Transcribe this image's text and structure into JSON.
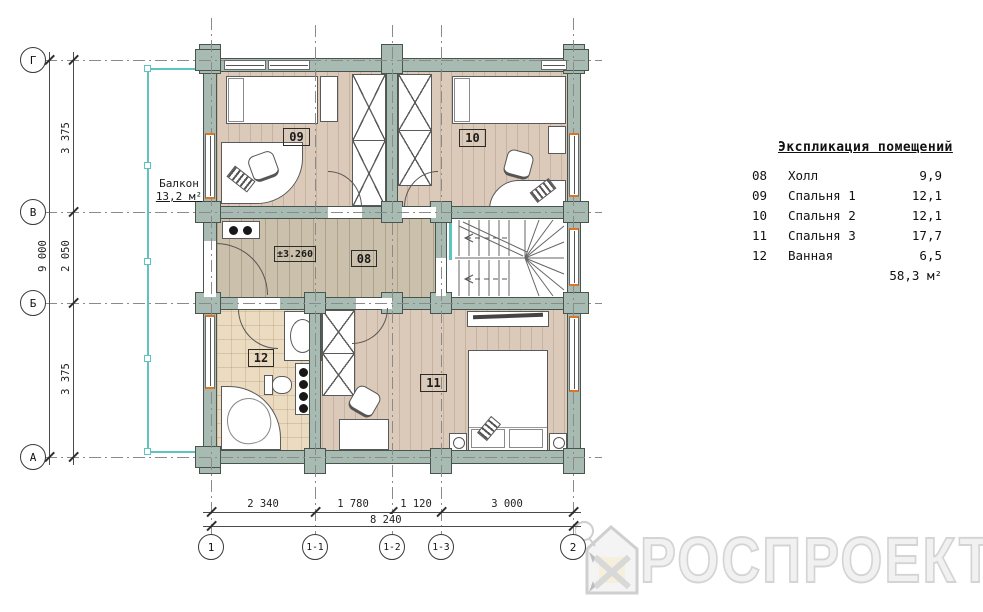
{
  "drawing": {
    "axes_rows": [
      {
        "label": "Г"
      },
      {
        "label": "В"
      },
      {
        "label": "Б"
      },
      {
        "label": "А"
      }
    ],
    "axes_cols": [
      {
        "label": "1"
      },
      {
        "label": "1-1"
      },
      {
        "label": "1-2"
      },
      {
        "label": "1-3"
      },
      {
        "label": "2"
      }
    ],
    "dims_left": {
      "seg1": "3 375",
      "seg2": "2 050",
      "seg3": "3 375",
      "overall": "9 000"
    },
    "dims_bottom": {
      "seg1": "2 340",
      "seg2": "1 780",
      "seg3": "1 120",
      "seg4": "3 000",
      "overall": "8 240"
    },
    "balcony": {
      "name": "Балкон",
      "area": "13,2 м²"
    },
    "elevation": "±3.260",
    "rooms": {
      "hall": "08",
      "bed1": "09",
      "bed2": "10",
      "bed3": "11",
      "bath": "12"
    }
  },
  "legend": {
    "title": "Экспликация помещений",
    "rows": [
      {
        "num": "08",
        "name": "Холл",
        "area": "9,9"
      },
      {
        "num": "09",
        "name": "Спальня 1",
        "area": "12,1"
      },
      {
        "num": "10",
        "name": "Спальня 2",
        "area": "12,1"
      },
      {
        "num": "11",
        "name": "Спальня 3",
        "area": "17,7"
      },
      {
        "num": "12",
        "name": "Ванная",
        "area": "6,5"
      }
    ],
    "total": "58,3 м²"
  },
  "watermark": {
    "brand": "РОСПРОЕКТ"
  },
  "colors": {
    "wall": "#a8bbb2",
    "wall_border": "#49544e",
    "floor_wood": "#dbc9b9",
    "floor_hall": "#cbc0ab",
    "floor_tile": "#ebdbc0",
    "balcony_teal": "#5fc4c0",
    "window_jamb_orange": "#e0741f",
    "watermark_gray": "#d4d4d4"
  }
}
